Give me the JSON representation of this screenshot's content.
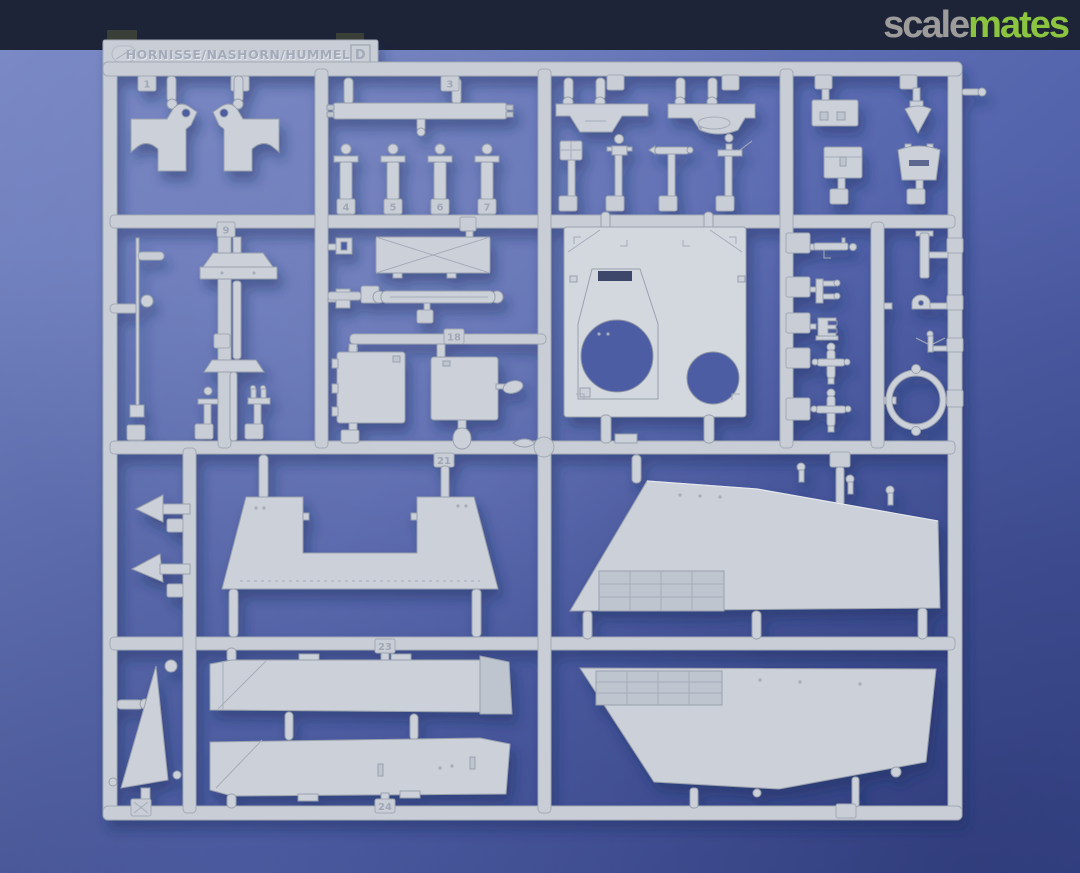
{
  "photo": {
    "description": "Light grey injection-moulded sprue of a Hornisse/Nashorn/Hummel model kit photographed on a blue background",
    "background_color": "#5565ad",
    "plastic_color": "#ccd1d9"
  },
  "watermark": {
    "bar_color": "#1d2438",
    "word_part1": "scale",
    "word_part2": "mates",
    "part1_color": "#9d9c9a",
    "part2_color": "#8bc53f"
  },
  "sprue_tag": {
    "title": "HORNISSE/NASHORN/HUMMEL",
    "letter": "D"
  },
  "part_numbers": [
    "1",
    "2",
    "3",
    "4",
    "5",
    "6",
    "7",
    "9",
    "18",
    "21",
    "23",
    "24"
  ]
}
